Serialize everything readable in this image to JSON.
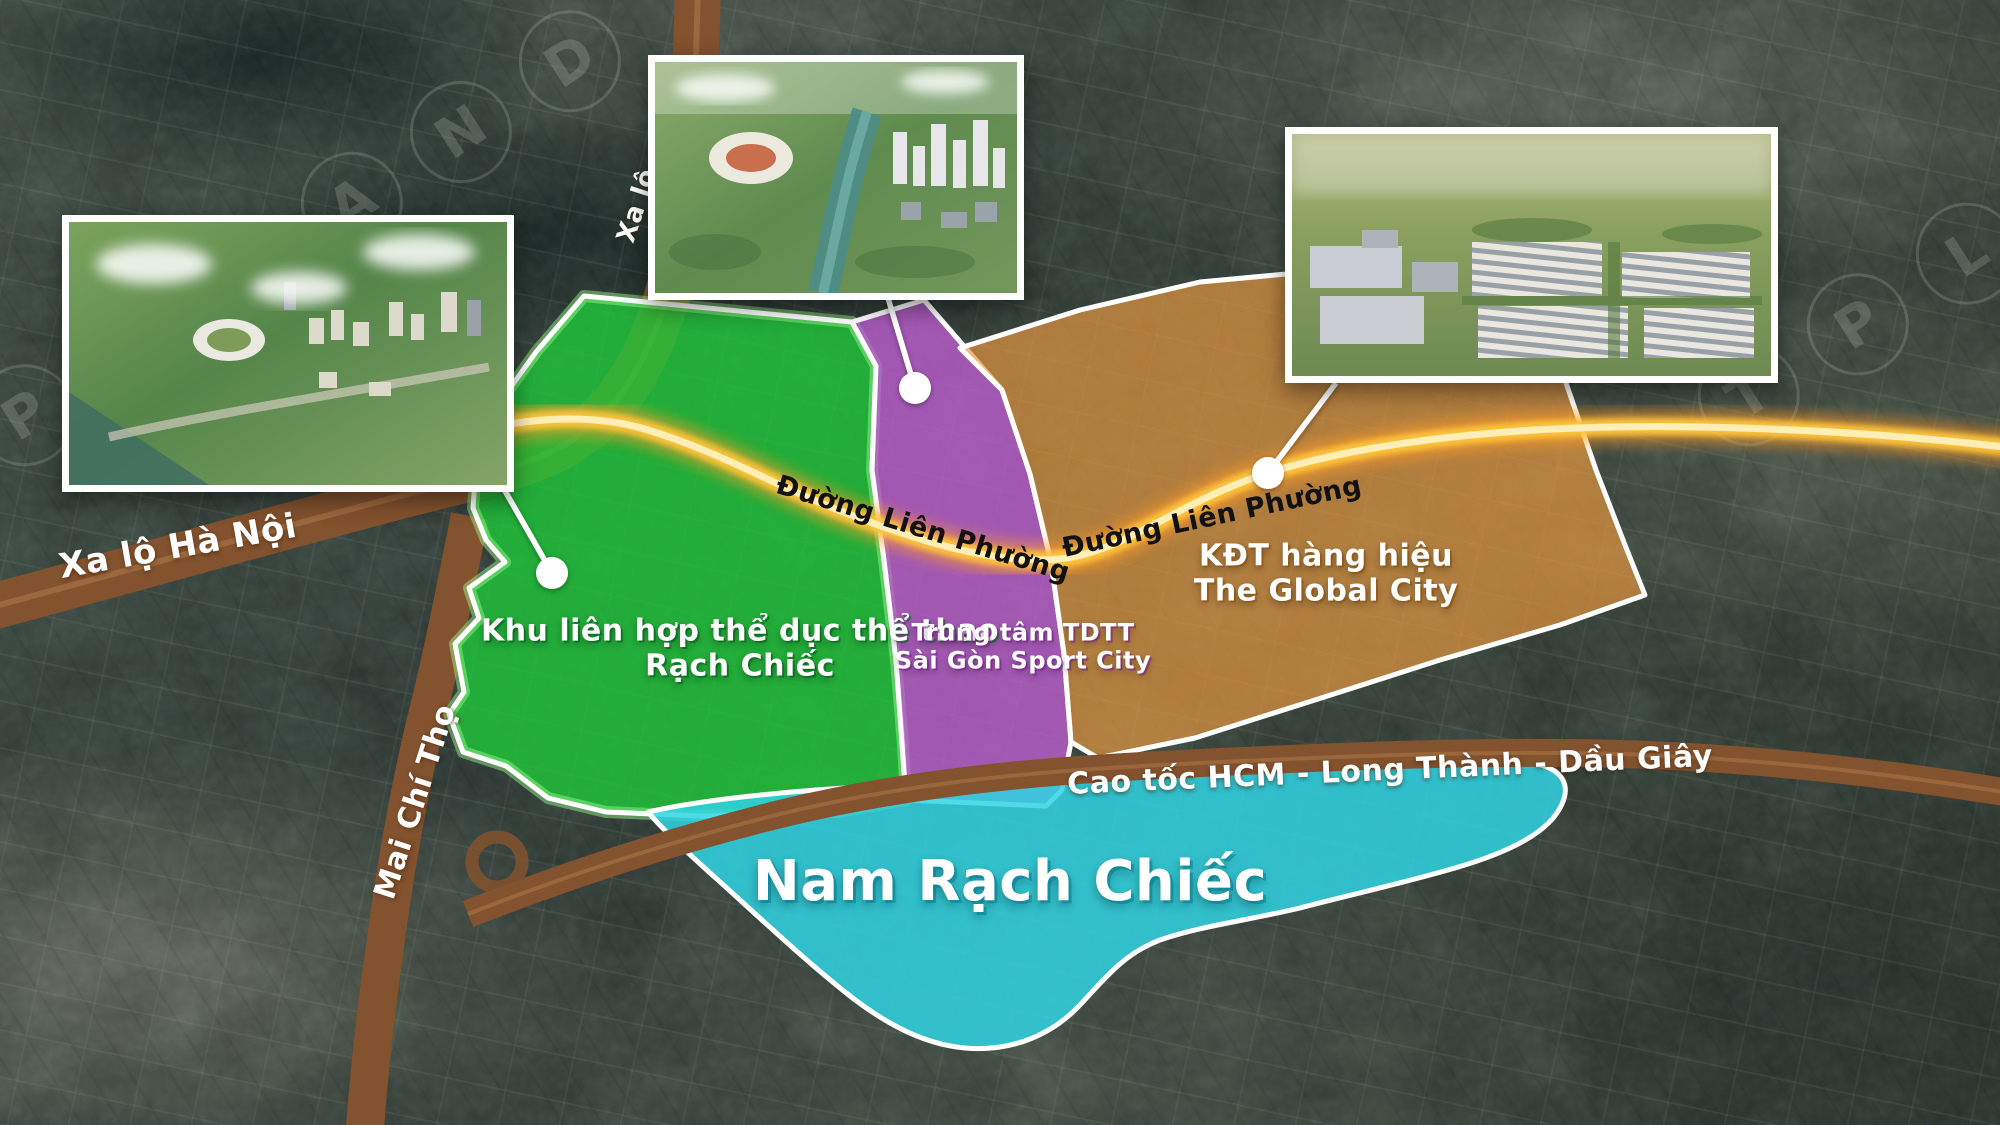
{
  "roads": {
    "xa_lo_ha_noi": "Xa lộ Hà Nội",
    "xa_lo_partial": "Xa lộ",
    "mai_chi_tho": "Mai Chí Thọ",
    "duong_lien_phuong_1": "Đường Liên Phường",
    "duong_lien_phuong_2": "Đường Liên Phường",
    "cao_toc": "Cao tốc HCM - Long Thành - Dầu Giây"
  },
  "zones": [
    {
      "id": "green",
      "label_line1": "Khu liên hợp thể dục thể thao",
      "label_line2": "Rạch Chiếc",
      "color": "#1ecb38"
    },
    {
      "id": "purple",
      "label_line1": "Trung tâm TDTT",
      "label_line2": "Sài Gòn Sport City",
      "color": "#c05fd3"
    },
    {
      "id": "orange",
      "label_line1": "KĐT hàng hiệu",
      "label_line2": "The Global City",
      "color": "#e8983f"
    },
    {
      "id": "cyan",
      "label_line1": "Nam Rạch Chiếc",
      "label_line2": "",
      "color": "#2fd4e3"
    }
  ],
  "watermarks": {
    "left_letters": [
      "P",
      "I",
      "L",
      "A",
      "N",
      "D"
    ],
    "right_letters": [
      "T",
      "P",
      "L",
      "A"
    ]
  },
  "colors": {
    "road_brown": "#83522e",
    "road_brown_light": "#ad7848",
    "road_glow_outer": "#ff9a26",
    "road_glow_mid": "#ffc53a",
    "road_glow_core": "#fff0bd",
    "connector_white": "#ffffff"
  }
}
